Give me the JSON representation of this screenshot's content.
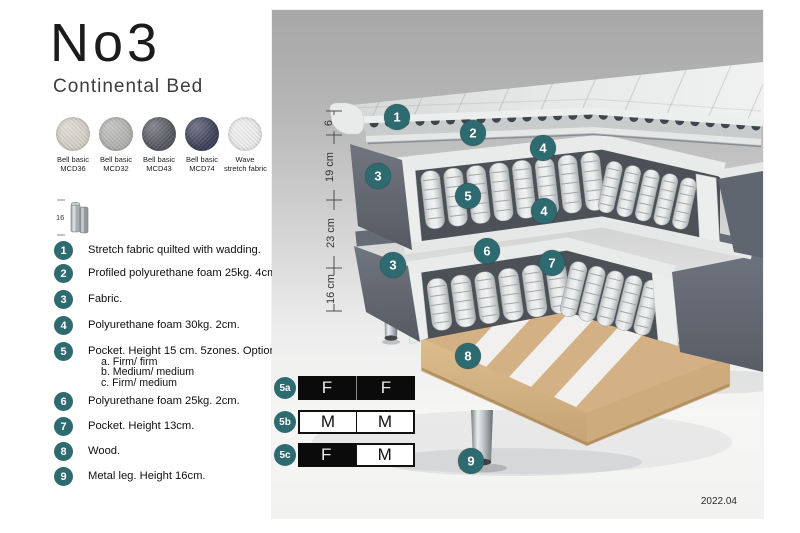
{
  "title": "No3",
  "subtitle": "Continental Bed",
  "swatches": [
    {
      "label_line1": "Bell basic",
      "label_line2": "MCD36",
      "color": "#d6d2c8"
    },
    {
      "label_line1": "Bell basic",
      "label_line2": "MCD32",
      "color": "#b3b3b1"
    },
    {
      "label_line1": "Bell basic",
      "label_line2": "MCD43",
      "color": "#565860"
    },
    {
      "label_line1": "Bell basic",
      "label_line2": "MCD74",
      "color": "#3c4158"
    },
    {
      "label_line1": "Wave",
      "label_line2": "stretch fabric",
      "color": "#ecedec"
    }
  ],
  "leg_icon": {
    "height_label": "16"
  },
  "legend": [
    {
      "num": "1",
      "text": "Stretch fabric quilted with wadding."
    },
    {
      "num": "2",
      "text": "Profiled polyurethane foam 25kg. 4cm."
    },
    {
      "num": "3",
      "text": "Fabric."
    },
    {
      "num": "4",
      "text": "Polyurethane foam 30kg. 2cm."
    },
    {
      "num": "5",
      "text": "Pocket. Height 15 cm. 5zones. Option:",
      "options": [
        "a. Firm/ firm",
        "b. Medium/ medium",
        "c. Firm/ medium"
      ]
    },
    {
      "num": "6",
      "text": "Polyurethane foam 25kg. 2cm."
    },
    {
      "num": "7",
      "text": "Pocket. Height 13cm."
    },
    {
      "num": "8",
      "text": "Wood."
    },
    {
      "num": "9",
      "text": "Metal leg. Height 16cm."
    }
  ],
  "diagram": {
    "measurements": [
      "6",
      "19 cm",
      "23 cm",
      "16 cm"
    ],
    "badges": [
      "1",
      "2",
      "4",
      "3",
      "5",
      "4",
      "6",
      "7",
      "3",
      "8",
      "9"
    ],
    "firmness_rows": [
      {
        "badge": "5a",
        "cells": [
          {
            "label": "F",
            "variant": "dark"
          },
          {
            "label": "F",
            "variant": "dark"
          }
        ]
      },
      {
        "badge": "5b",
        "cells": [
          {
            "label": "M",
            "variant": "light"
          },
          {
            "label": "M",
            "variant": "light"
          }
        ]
      },
      {
        "badge": "5c",
        "cells": [
          {
            "label": "F",
            "variant": "dark"
          },
          {
            "label": "M",
            "variant": "light"
          }
        ]
      }
    ],
    "version": "2022.04"
  },
  "colors": {
    "badge_teal": "#2e6b70",
    "table_black": "#0b0b0b",
    "fabric_gray": "#5f656f",
    "spring_white": "#e3e5e6",
    "wood": "#d3b184"
  }
}
